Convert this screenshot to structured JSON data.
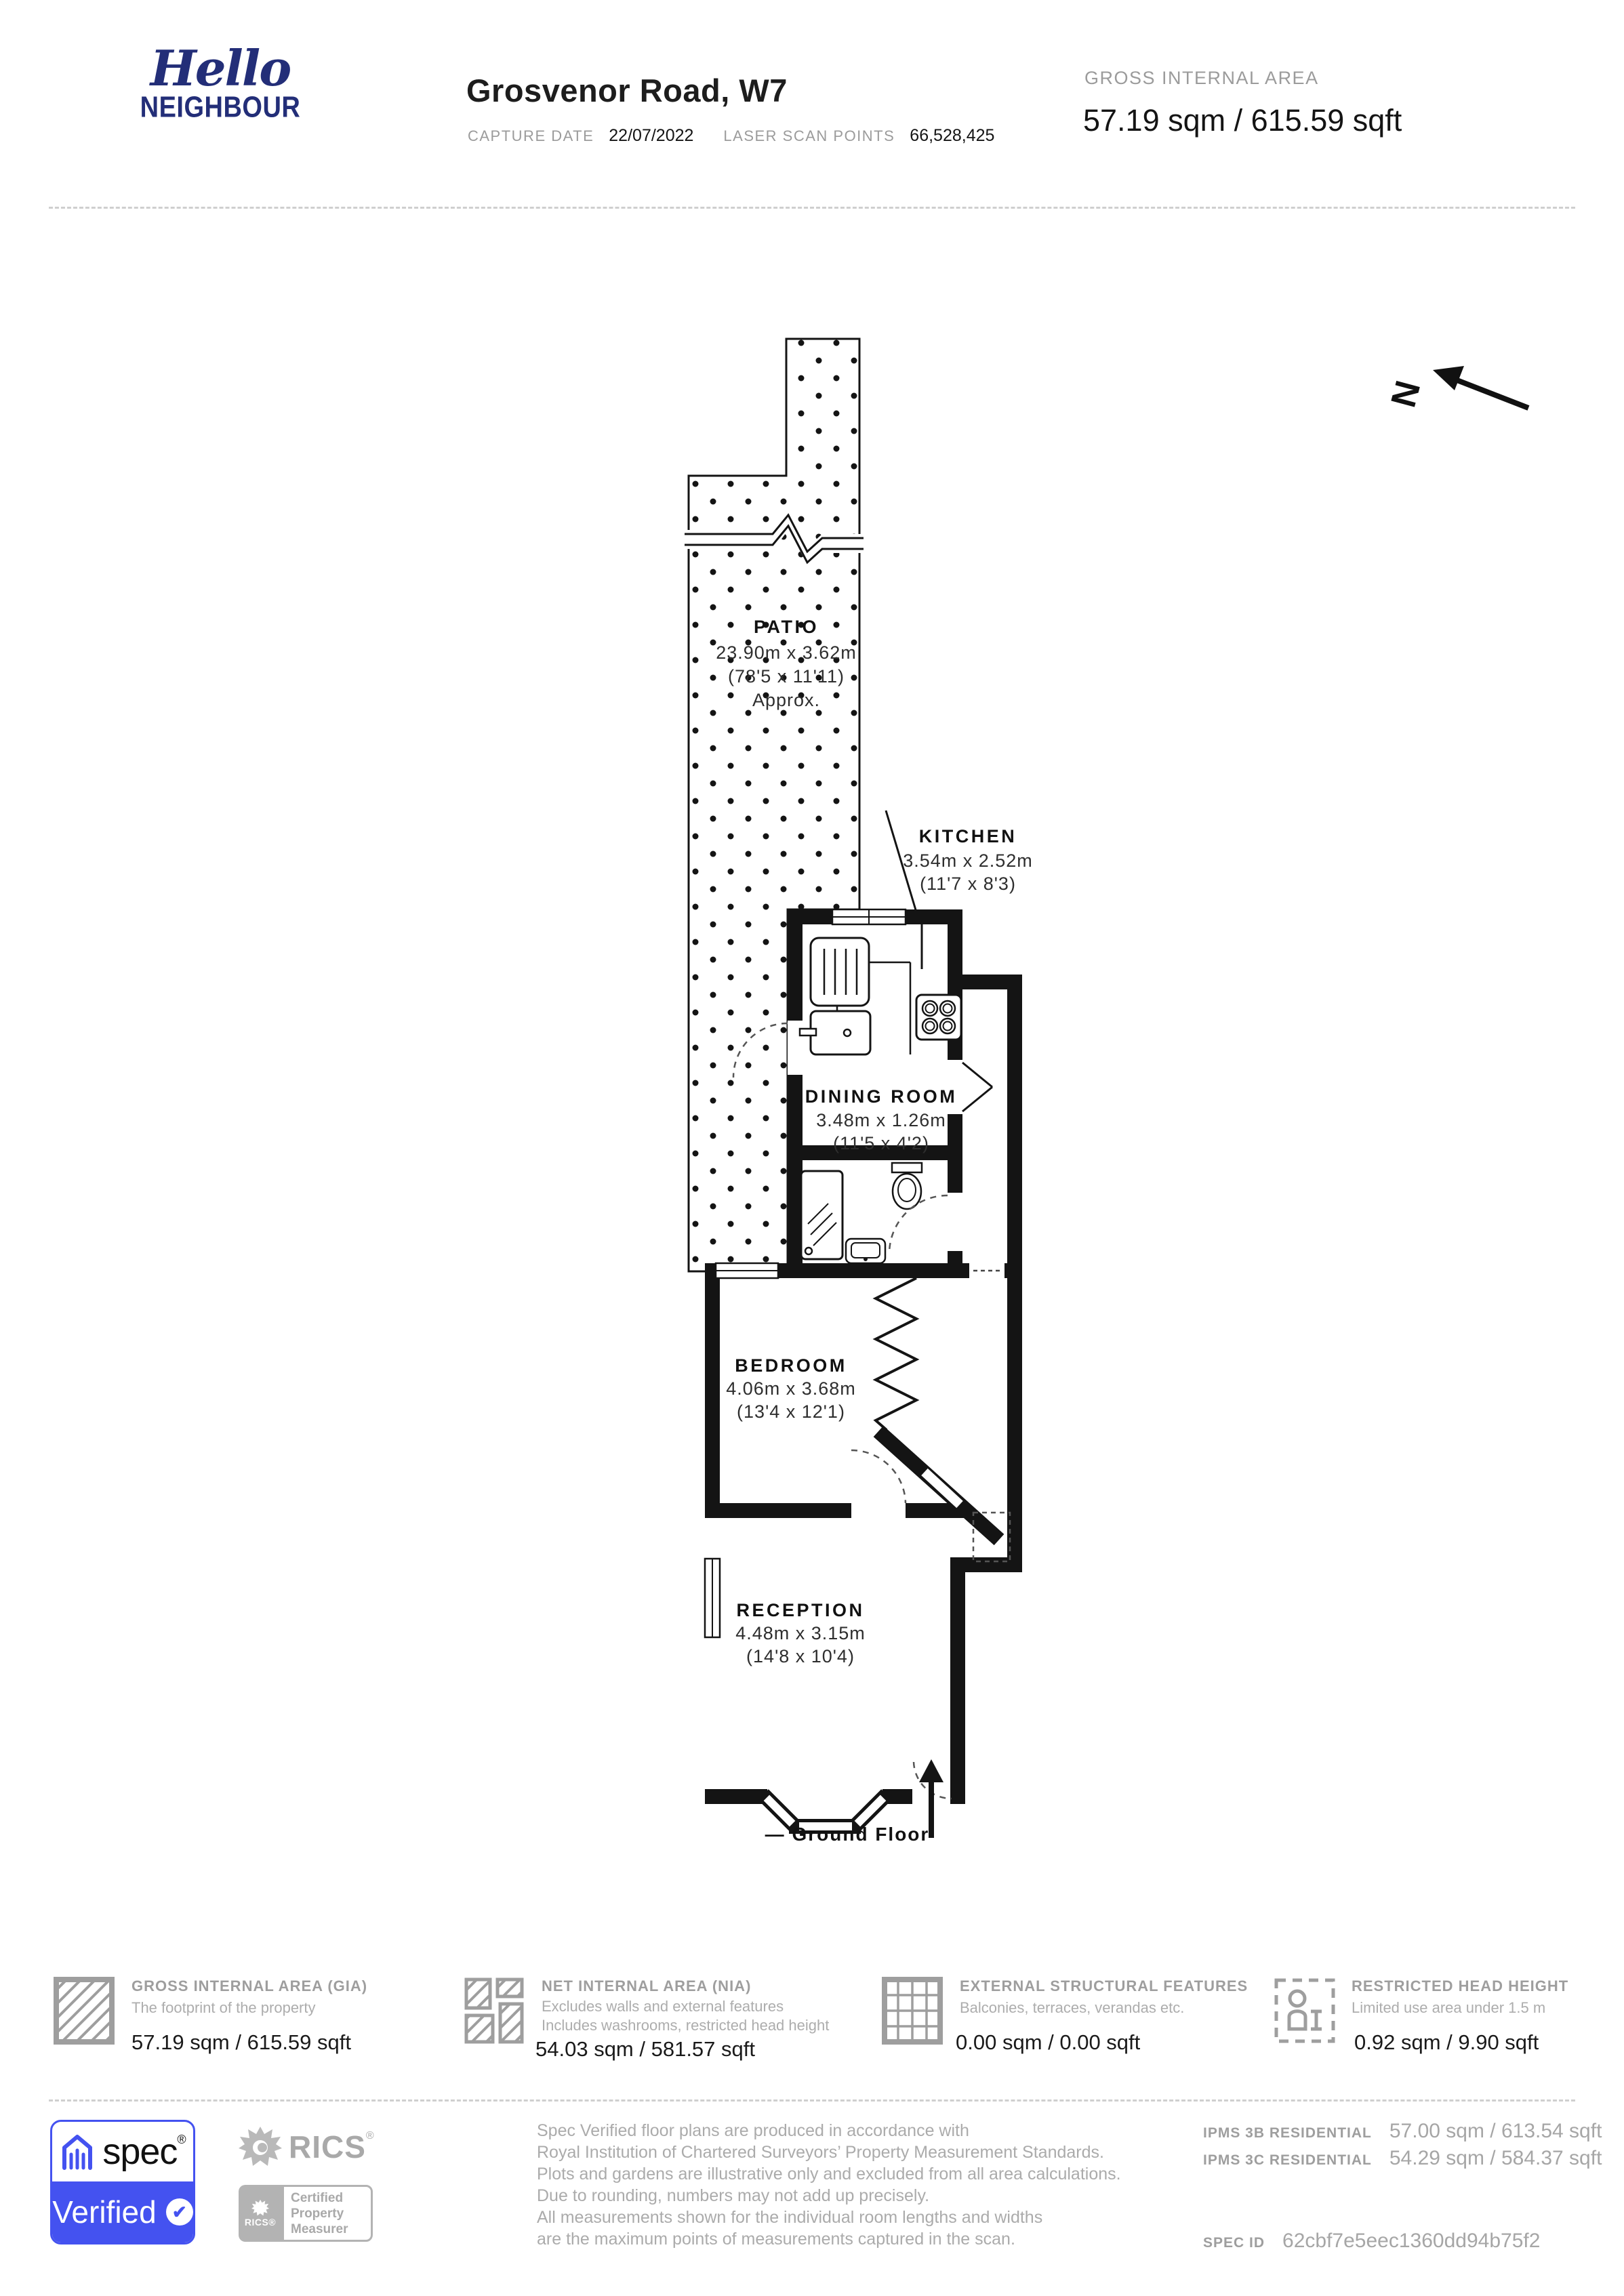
{
  "header": {
    "logo_line1": "Hello",
    "logo_line2": "NEIGHBOUR",
    "title": "Grosvenor Road, W7",
    "capture_date_label": "CAPTURE DATE",
    "capture_date_value": "22/07/2022",
    "laser_scan_label": "LASER SCAN POINTS",
    "laser_scan_value": "66,528,425",
    "gia_label": "GROSS INTERNAL AREA",
    "gia_value": "57.19 sqm / 615.59 sqft"
  },
  "floorplan": {
    "north_label": "N",
    "floor_label": "—  Ground Floor",
    "rooms": {
      "patio": {
        "name": "PATIO",
        "metric": "23.90m x 3.62m",
        "imperial": "(78'5 x 11'11)",
        "note": "Approx."
      },
      "kitchen": {
        "name": "KITCHEN",
        "metric": "3.54m x 2.52m",
        "imperial": "(11'7 x 8'3)"
      },
      "dining": {
        "name": "DINING ROOM",
        "metric": "3.48m x 1.26m",
        "imperial": "(11'5 x 4'2)"
      },
      "bedroom": {
        "name": "BEDROOM",
        "metric": "4.06m x 3.68m",
        "imperial": "(13'4 x 12'1)"
      },
      "reception": {
        "name": "RECEPTION",
        "metric": "4.48m x 3.15m",
        "imperial": "(14'8 x 10'4)"
      }
    }
  },
  "legend": {
    "gia": {
      "title": "GROSS INTERNAL AREA (GIA)",
      "line1": "The footprint of the property",
      "value": "57.19 sqm / 615.59 sqft"
    },
    "nia": {
      "title": "NET INTERNAL AREA (NIA)",
      "line1": "Excludes walls and external features",
      "line2": "Includes washrooms, restricted head height",
      "value": "54.03 sqm / 581.57 sqft"
    },
    "esf": {
      "title": "EXTERNAL STRUCTURAL FEATURES",
      "line1": "Balconies, terraces, verandas etc.",
      "value": "0.00 sqm / 0.00 sqft"
    },
    "rhh": {
      "title": "RESTRICTED HEAD HEIGHT",
      "line1": "Limited use area under 1.5 m",
      "value": "0.92 sqm / 9.90 sqft"
    }
  },
  "footer": {
    "spec_badge": {
      "brand": "spec",
      "reg": "®",
      "verified": "Verified",
      "check": "✔"
    },
    "rics": {
      "brand": "RICS",
      "reg": "®",
      "badge_brand": "RICS®",
      "badge_lines": [
        "Certified",
        "Property",
        "Measurer"
      ]
    },
    "note_lines": [
      "Spec Verified floor plans are produced in accordance with",
      "Royal Institution of Chartered Surveyors’ Property Measurement Standards.",
      "Plots and gardens are illustrative only and excluded from all area calculations.",
      "Due to rounding, numbers may not add up precisely.",
      "All measurements shown for the individual room lengths and widths",
      "are the maximum points of measurements captured in the scan."
    ],
    "ipms": [
      {
        "label": "IPMS 3B RESIDENTIAL",
        "value": "57.00 sqm / 613.54 sqft"
      },
      {
        "label": "IPMS 3C RESIDENTIAL",
        "value": "54.29 sqm / 584.37 sqft"
      }
    ],
    "spec_id_label": "SPEC ID",
    "spec_id_value": "62cbf7e5eec1360dd94b75f2"
  },
  "colors": {
    "brand_navy": "#232e78",
    "spec_blue": "#4452f0",
    "text_dark": "#1a1a1a",
    "label_gray": "#9b9b9b",
    "icon_gray": "#9e9e9e"
  }
}
